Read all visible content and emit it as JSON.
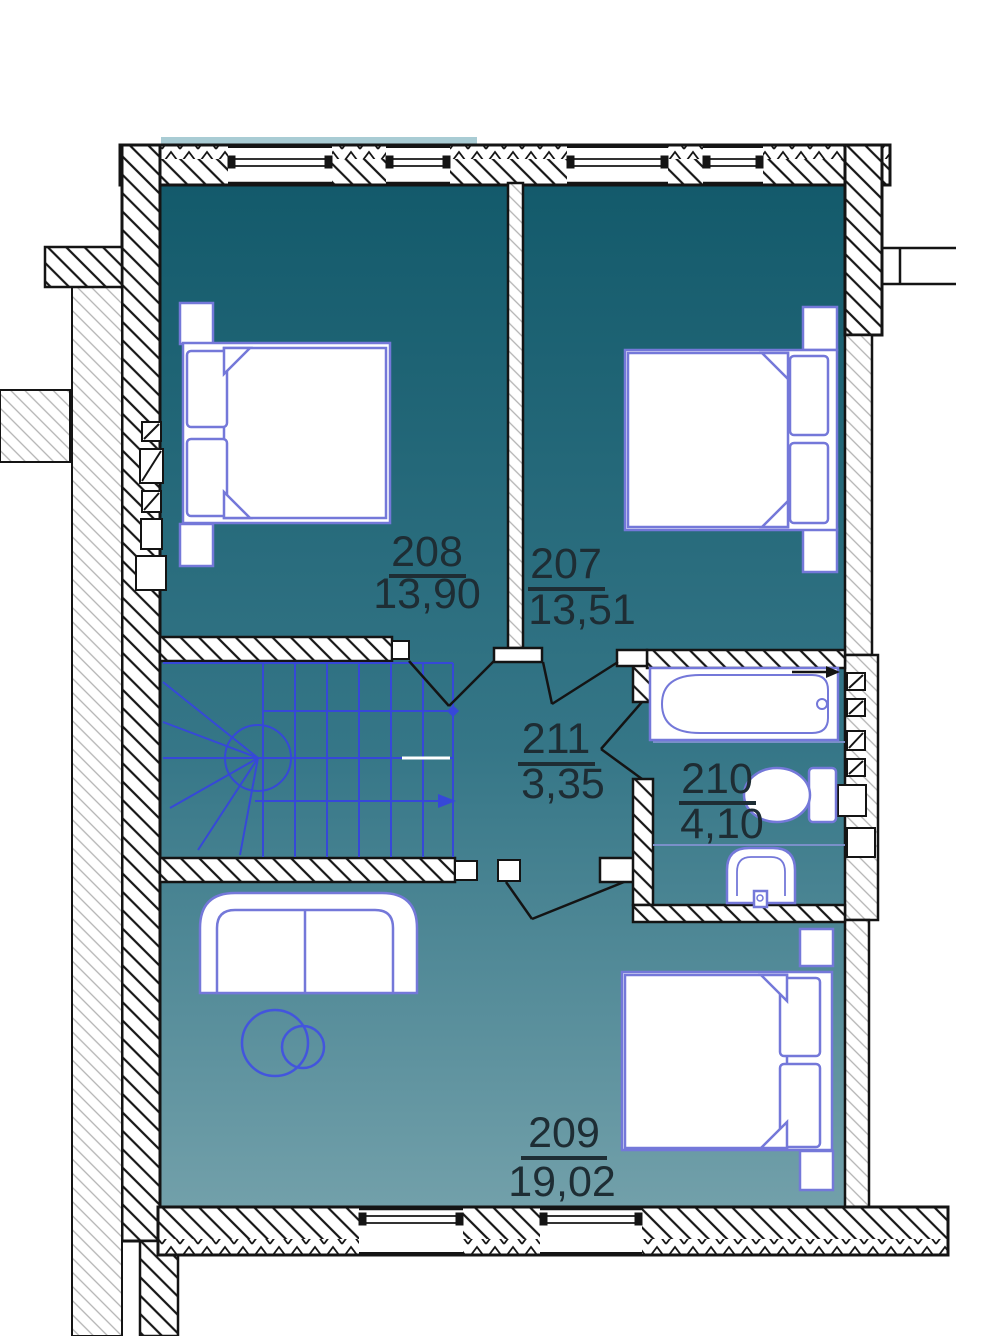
{
  "floorplan": {
    "rooms": [
      {
        "number": "208",
        "area": "13,90",
        "type": "bedroom",
        "furniture": [
          "double-bed",
          "nightstand",
          "nightstand"
        ]
      },
      {
        "number": "207",
        "area": "13,51",
        "type": "bedroom",
        "furniture": [
          "double-bed",
          "nightstand",
          "nightstand"
        ]
      },
      {
        "number": "211",
        "area": "3,35",
        "type": "hall",
        "furniture": [
          "staircase"
        ]
      },
      {
        "number": "210",
        "area": "4,10",
        "type": "bathroom",
        "furniture": [
          "bathtub",
          "toilet",
          "washbasin"
        ]
      },
      {
        "number": "209",
        "area": "19,02",
        "type": "living-bedroom",
        "furniture": [
          "sofa",
          "floor-lamp",
          "double-bed",
          "nightstand",
          "nightstand"
        ]
      }
    ],
    "colors": {
      "floor_gradient_top": "#135a6b",
      "floor_gradient_mid": "#357687",
      "floor_gradient_bottom": "#72a0aa",
      "wall_ink": "#141414",
      "furniture_stroke": "#7478d9",
      "stairs_stroke": "#3648d8",
      "lamp_stroke": "#4355dd",
      "label_ink": "#1e2d34",
      "window_sill": "#a9ccd4"
    }
  }
}
